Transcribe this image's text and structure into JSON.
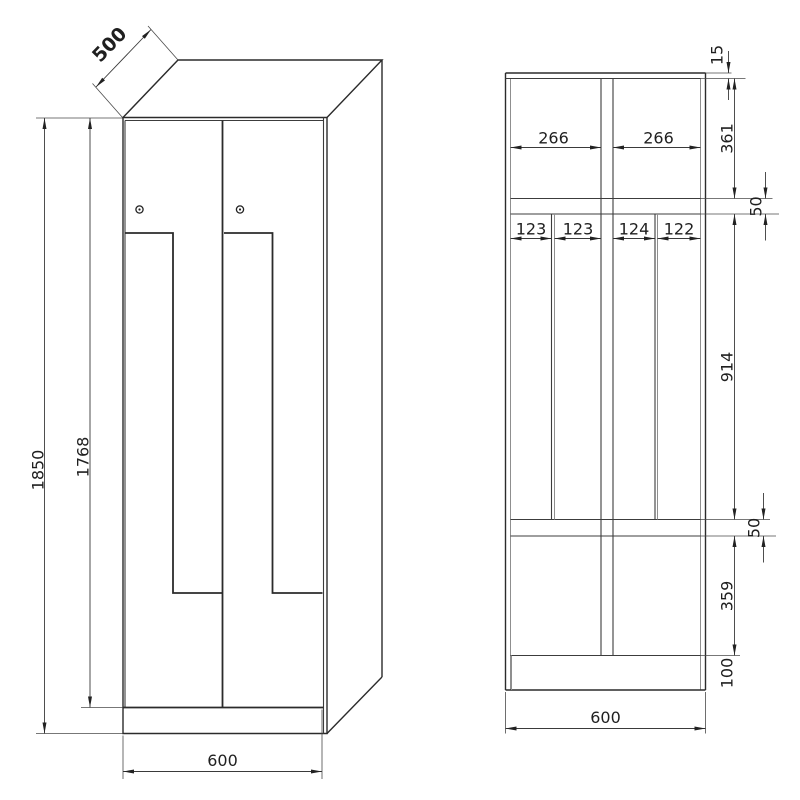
{
  "perspective_view": {
    "depth": "500",
    "overall_height": "1850",
    "door_height": "1768",
    "width": "600"
  },
  "section_view": {
    "top_panel": "15",
    "top_compartment": "361",
    "shelf_top": "50",
    "middle_compartment": "914",
    "shelf_bottom": "50",
    "bottom_compartment": "359",
    "plinth": "100",
    "width": "600",
    "opening_left": "266",
    "opening_right": "266",
    "slots": [
      "123",
      "123",
      "124",
      "122"
    ]
  },
  "colors": {
    "depth_dim_text": "#24509e",
    "line": "#2b2b2b"
  }
}
